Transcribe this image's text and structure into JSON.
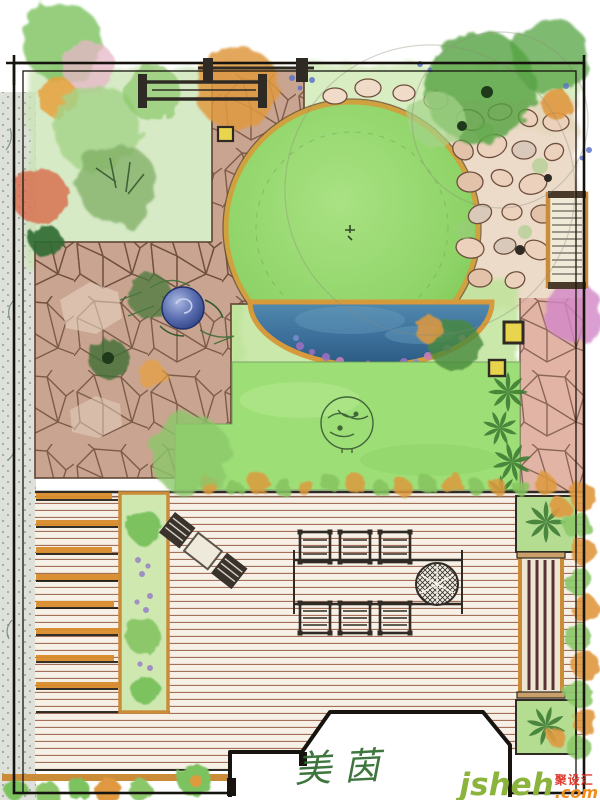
{
  "drawing": {
    "kind": "hand-drawn residential garden landscape plan (watercolor style)",
    "signature": {
      "text": "美茵"
    },
    "watermark": {
      "brand": "jsheh",
      "brand_dot": "j",
      "domain": ".com",
      "badge": "聚设汇"
    }
  },
  "features": [
    "perimeter-border",
    "gravel-strip-west",
    "flagstone-path",
    "pergola-gate",
    "picnic-bench-north",
    "planting-bed-northwest",
    "circular-lawn",
    "top-planting-band",
    "rock-garden-east",
    "garden-bench-east",
    "half-moon-pond",
    "pond-flower-edge",
    "sphere-water-feature",
    "perennial-bed-west",
    "central-lawn",
    "specimen-tree-sketch",
    "palm-row",
    "stepping-stone-path",
    "wood-deck",
    "deck-stairs",
    "planter-strip",
    "lounge-chair-set",
    "dining-table",
    "dining-chairs",
    "fire-pit",
    "deck-bench-east",
    "deck-planter-north",
    "deck-planter-south",
    "hedge-east",
    "house-outline",
    "garden-lamp-north",
    "garden-lamp-east-1",
    "garden-lamp-east-2",
    "bottom-shrub-row",
    "signature",
    "watermark"
  ],
  "palette": {
    "paper": "#ffffff",
    "ink": "#17140f",
    "lawn": "#8fd468",
    "lawn_rim": "#cfa13f",
    "pond_water": "#3c6f9a",
    "pond_rim": "#d69a3c",
    "deck_board": "#f6f0e7",
    "deck_line": "#a5705a",
    "flagstone": "#c9a490",
    "stone_line": "#6e4e3c",
    "gravel": "#dcdfd8",
    "timber": "#cb8c3a",
    "foliage_light": "#a4d488",
    "foliage_mid": "#7cc25e",
    "foliage_dark": "#55a342",
    "foliage_deep": "#2e6b33",
    "autumn_orange": "#e0993f",
    "autumn_red": "#d96a4a",
    "blossom_pink": "#e8b7c9",
    "blossom_magenta": "#d287c7",
    "flower_purple": "#8f7cc9",
    "flower_blue": "#5a74c8",
    "lamp_yellow": "#e8d44d",
    "bench_slat_red": "#5a3038",
    "signature_green": "#2e6b2e",
    "watermark_green": "#8bb43c",
    "watermark_orange": "#f08c1e",
    "watermark_red": "#e23c2e"
  }
}
